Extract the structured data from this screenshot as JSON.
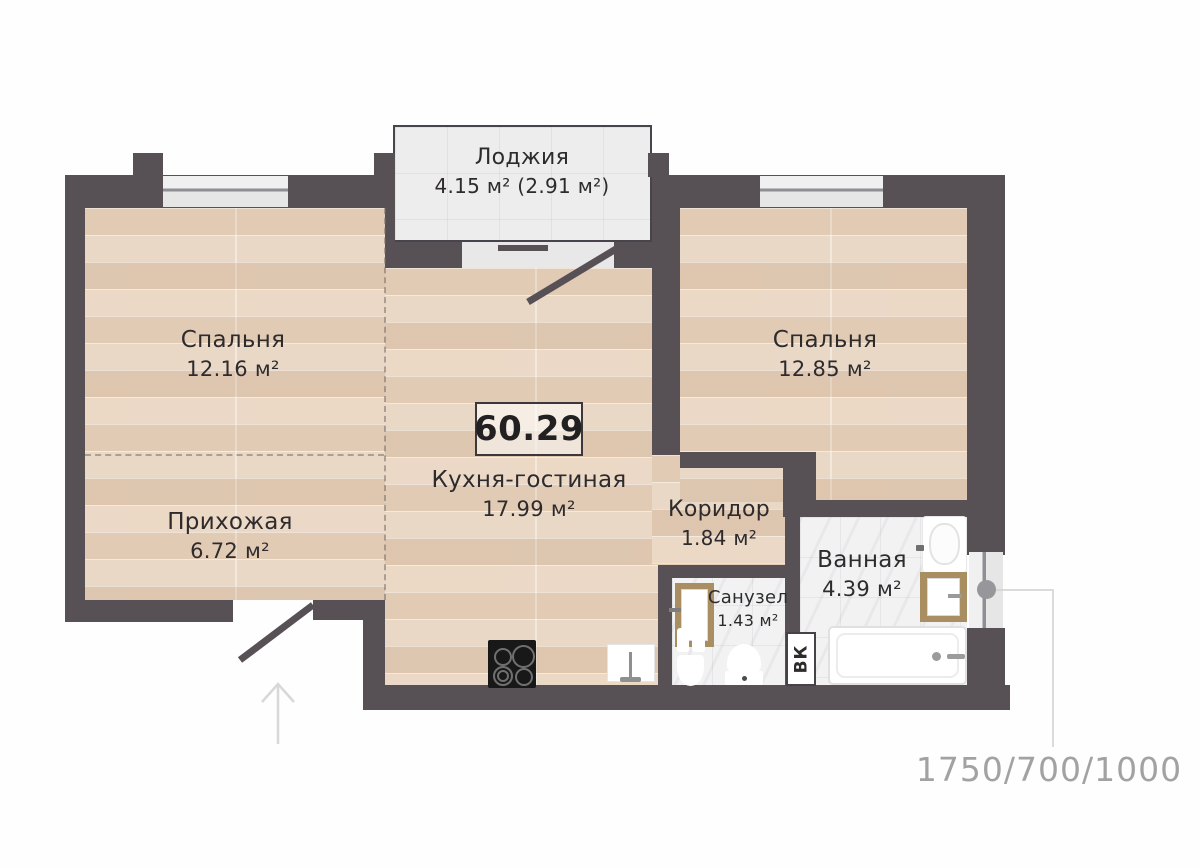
{
  "plan": {
    "total_area": "60.29",
    "vk_label": "ВК",
    "dimensions_label": "1750/700/1000",
    "rooms": [
      {
        "id": "loggia",
        "name": "Лоджия",
        "area": "4.15 м² (2.91 м²)"
      },
      {
        "id": "bedroom-left",
        "name": "Спальня",
        "area": "12.16 м²"
      },
      {
        "id": "bedroom-right",
        "name": "Спальня",
        "area": "12.85 м²"
      },
      {
        "id": "kitchen-living",
        "name": "Кухня-гостиная",
        "area": "17.99 м²"
      },
      {
        "id": "hallway",
        "name": "Прихожая",
        "area": "6.72 м²"
      },
      {
        "id": "corridor",
        "name": "Коридор",
        "area": "1.84 м²"
      },
      {
        "id": "wc",
        "name": "Санузел",
        "area": "1.43 м²"
      },
      {
        "id": "bathroom",
        "name": "Ванная",
        "area": "4.39 м²"
      }
    ],
    "colors": {
      "wall": "#575156",
      "wood_floor": "#e8d4c0",
      "tile_floor": "#f2f2f3",
      "loggia_floor": "#ededee",
      "door_frame": "#a98e61",
      "label_text": "#2e2b2d",
      "dimension_text": "#a2a2a2"
    }
  }
}
